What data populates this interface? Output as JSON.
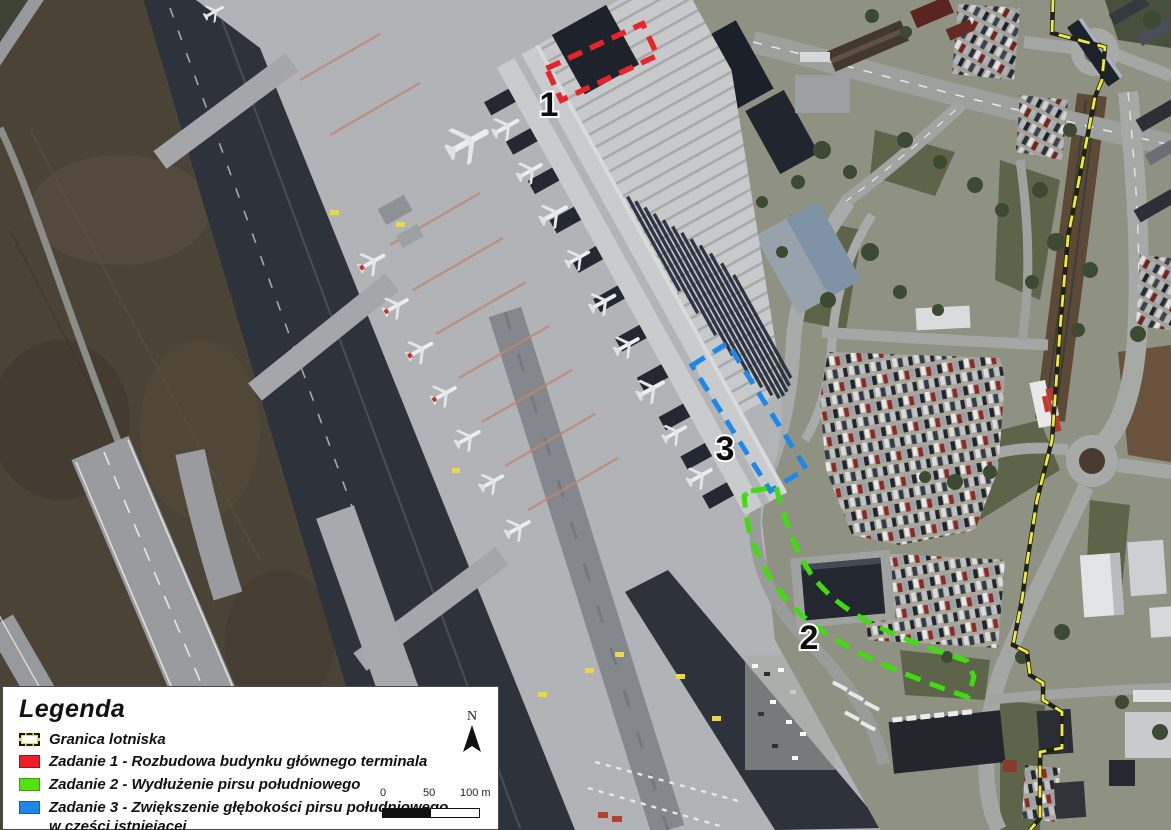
{
  "map": {
    "labels": [
      {
        "id": "zadanie-1",
        "text": "1"
      },
      {
        "id": "zadanie-2",
        "text": "2"
      },
      {
        "id": "zadanie-3",
        "text": "3"
      }
    ],
    "colors": {
      "boundary_yellow": "#f1ec38",
      "zadanie1_red": "#e8232a",
      "zadanie2_green": "#3fdd10",
      "zadanie3_blue": "#1e88e8"
    }
  },
  "legend": {
    "title": "Legenda",
    "items": [
      {
        "swatch": "boundary",
        "label": "Granica lotniska"
      },
      {
        "swatch": "red",
        "color": "#ee1c24",
        "label": "Zadanie 1 - Rozbudowa budynku głównego terminala"
      },
      {
        "swatch": "green",
        "color": "#55e011",
        "label": "Zadanie 2 - Wydłużenie pirsu południowego"
      },
      {
        "swatch": "blue",
        "color": "#1d87e8",
        "label": "Zadanie 3 - Zwiększenie głębokości pirsu południowego",
        "label_line2": "w części istniejącej"
      }
    ]
  },
  "north_arrow": {
    "label": "N"
  },
  "scalebar": {
    "labels": [
      "0",
      "50",
      "100 m"
    ]
  }
}
